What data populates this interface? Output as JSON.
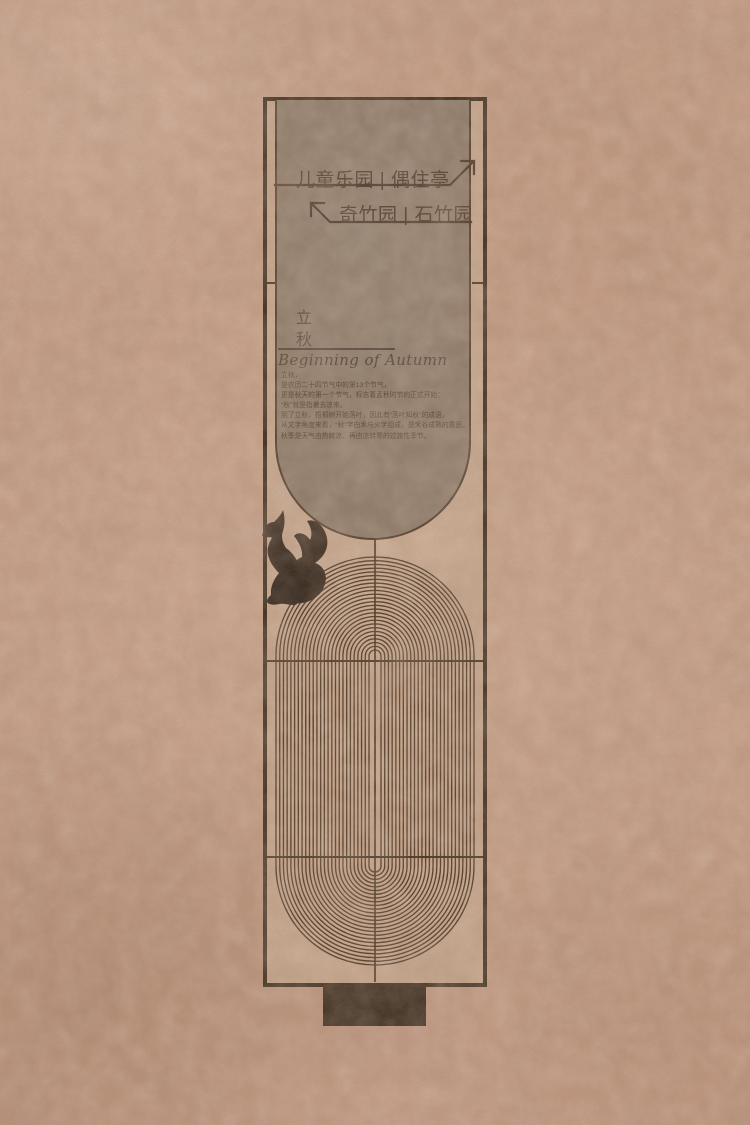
{
  "sign": {
    "type_label": "park wayfinding pylon",
    "directions": {
      "row1": {
        "text": "儿童乐园 | 偶住亭",
        "arrow": "up-right"
      },
      "row2": {
        "text": "奇竹园 | 石竹园",
        "arrow": "up-left"
      }
    },
    "solar_term": {
      "zh": "立秋",
      "en": "Beginning of Autumn"
    },
    "description": {
      "lines": [
        "立秋，",
        "是农历二十四节气中的第13个节气，",
        "更是秋天的第一个节气，标志着孟秋时节的正式开始：",
        "“秋”就是指暑去凉来。",
        "到了立秋，梧桐树开始落叶，因此有“落叶知秋”的成语。",
        "从文字角度来看，“秋”字由禾与火字组成，是禾谷成熟的意思。",
        "秋季是天气由热转凉、再由凉转寒的过渡性季节。"
      ]
    }
  },
  "icons": {
    "squirrel": "squirrel-silhouette",
    "arrow_up_right": "arrow-up-right",
    "arrow_up_left": "arrow-up-left"
  },
  "colors": {
    "paper": "#c79f88",
    "sign_face": "#c9a88f",
    "head_panel": "#8e7c6b",
    "ink_dark": "#392a1b",
    "line_brown": "#4a3522"
  }
}
